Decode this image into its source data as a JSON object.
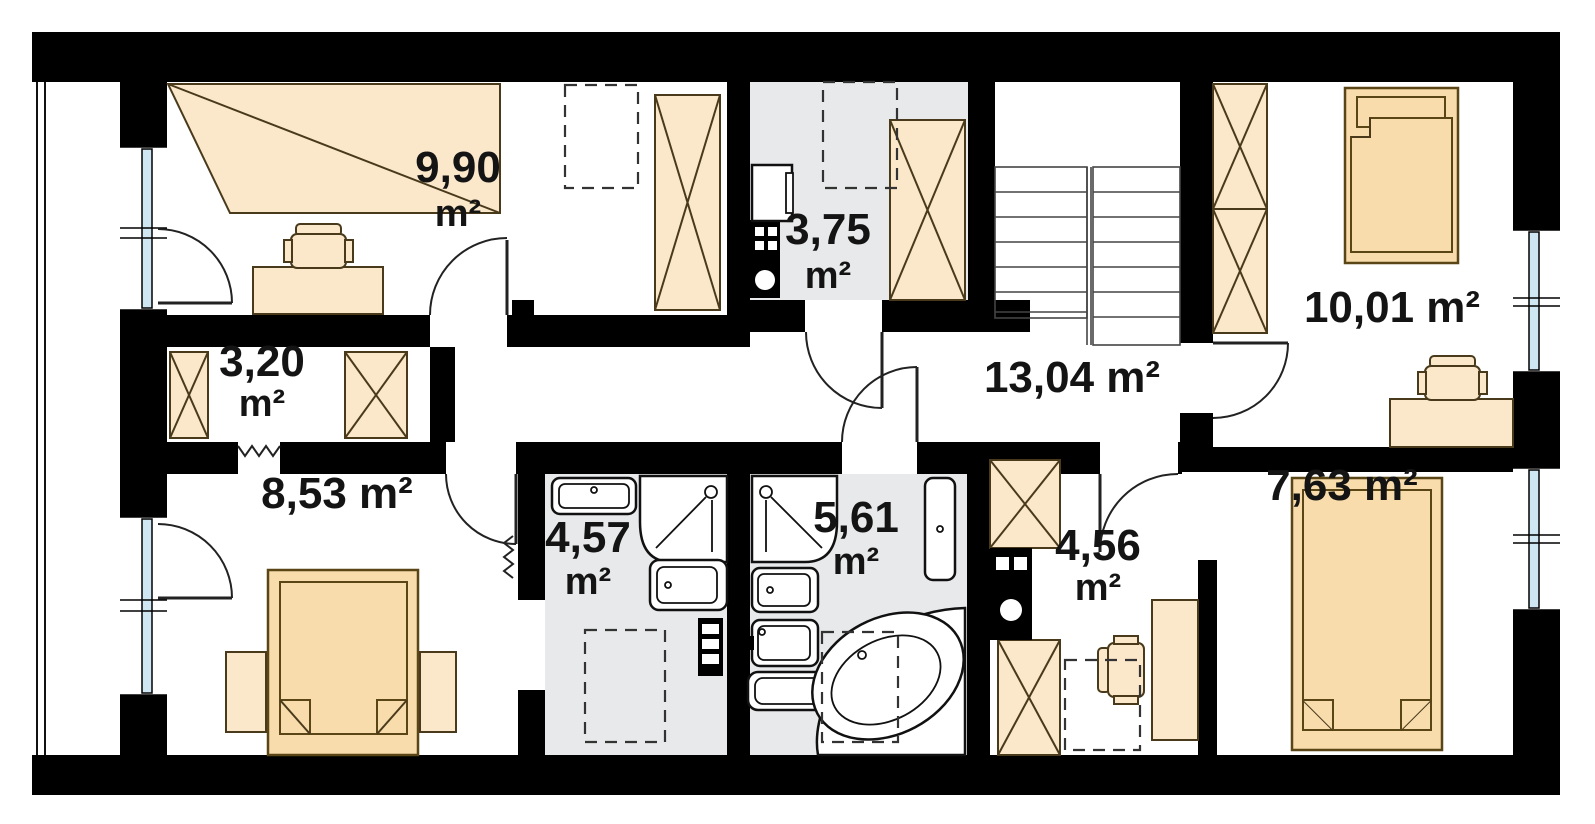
{
  "plan": {
    "title": "Attic floor plan",
    "unit": "m²",
    "rooms": [
      {
        "id": "room-top-left",
        "area": "9,90",
        "unit": "m²",
        "label": "9,90 m²"
      },
      {
        "id": "utility-room",
        "area": "3,75",
        "unit": "m²",
        "label": "3,75 m²"
      },
      {
        "id": "closet-left",
        "area": "3,20",
        "unit": "m²",
        "label": "3,20 m²"
      },
      {
        "id": "hall-staircase",
        "area": "13,04",
        "unit": "m²",
        "label": "13,04 m²"
      },
      {
        "id": "room-top-right",
        "area": "10,01",
        "unit": "m²",
        "label": "10,01 m²"
      },
      {
        "id": "bedroom-left",
        "area": "8,53",
        "unit": "m²",
        "label": "8,53 m²"
      },
      {
        "id": "bathroom-left",
        "area": "4,57",
        "unit": "m²",
        "label": "4,57 m²"
      },
      {
        "id": "bathroom-right",
        "area": "5,61",
        "unit": "m²",
        "label": "5,61 m²"
      },
      {
        "id": "closet-right",
        "area": "4,56",
        "unit": "m²",
        "label": "4,56 m²"
      },
      {
        "id": "bedroom-right",
        "area": "7,63",
        "unit": "m²",
        "label": "7,63 m²"
      }
    ],
    "symbols": {
      "wardrobe": "wardrobe-crossed-box",
      "bed": "bed-with-pillow-and-blanket",
      "desk": "desk-with-office-chair",
      "shower": "shower-tray",
      "washbasin": "washbasin",
      "toilet": "toilet",
      "corner_bathtub": "corner-bathtub",
      "washing_machine": "washing-machine",
      "chimney": "chimney-flue-block",
      "staircase": "double-flight-staircase",
      "radiator": "zigzag-radiator",
      "roof_window": "dashed-roof-window-outline",
      "window": "window-glazing-strip"
    },
    "colors": {
      "wall": "#000000",
      "furniture_fill": "#fbe8cb",
      "bed_fill": "#f8dcab",
      "wet_room_floor": "#e8e9ea",
      "glazing": "#cfe7f3",
      "background": "#ffffff"
    }
  }
}
